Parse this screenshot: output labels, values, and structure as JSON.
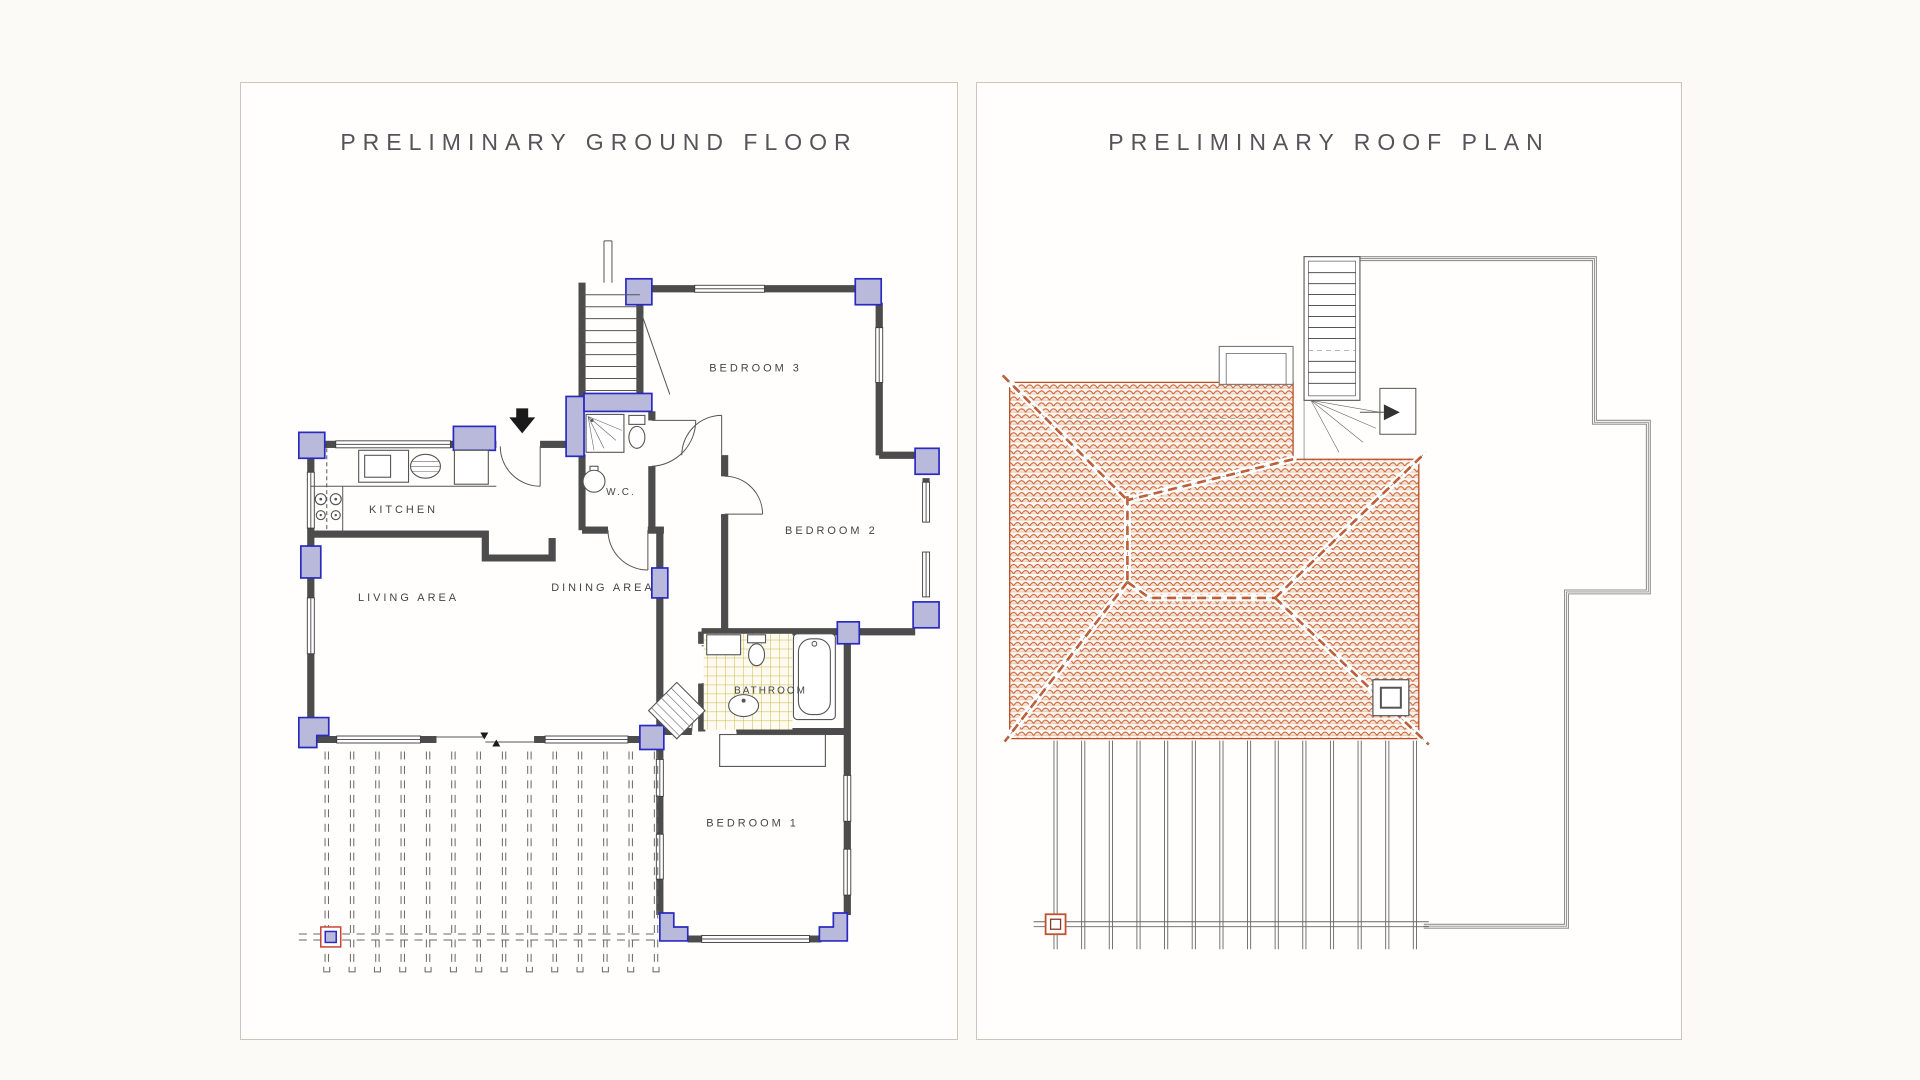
{
  "panels": {
    "ground_floor": {
      "title": "PRELIMINARY GROUND FLOOR"
    },
    "roof": {
      "title": "PRELIMINARY ROOF PLAN"
    }
  },
  "ground_floor_labels": {
    "kitchen": "KITCHEN",
    "living_area": "LIVING AREA",
    "dining_area": "DINING AREA",
    "wc": "W.C.",
    "bedroom3": "BEDROOM 3",
    "bedroom2": "BEDROOM 2",
    "bathroom": "BATHROOM",
    "bedroom1": "BEDROOM 1"
  },
  "colors": {
    "page_bg": "#fbfaf7",
    "panel_border": "#cbc5ba",
    "column_fill": "#b9badb",
    "column_stroke": "#2a2ac0",
    "roof_tile": "#c4572b",
    "bathroom_tile": "#cdb84a",
    "marker_red": "#cc4433",
    "wall": "#4c4c4c"
  }
}
